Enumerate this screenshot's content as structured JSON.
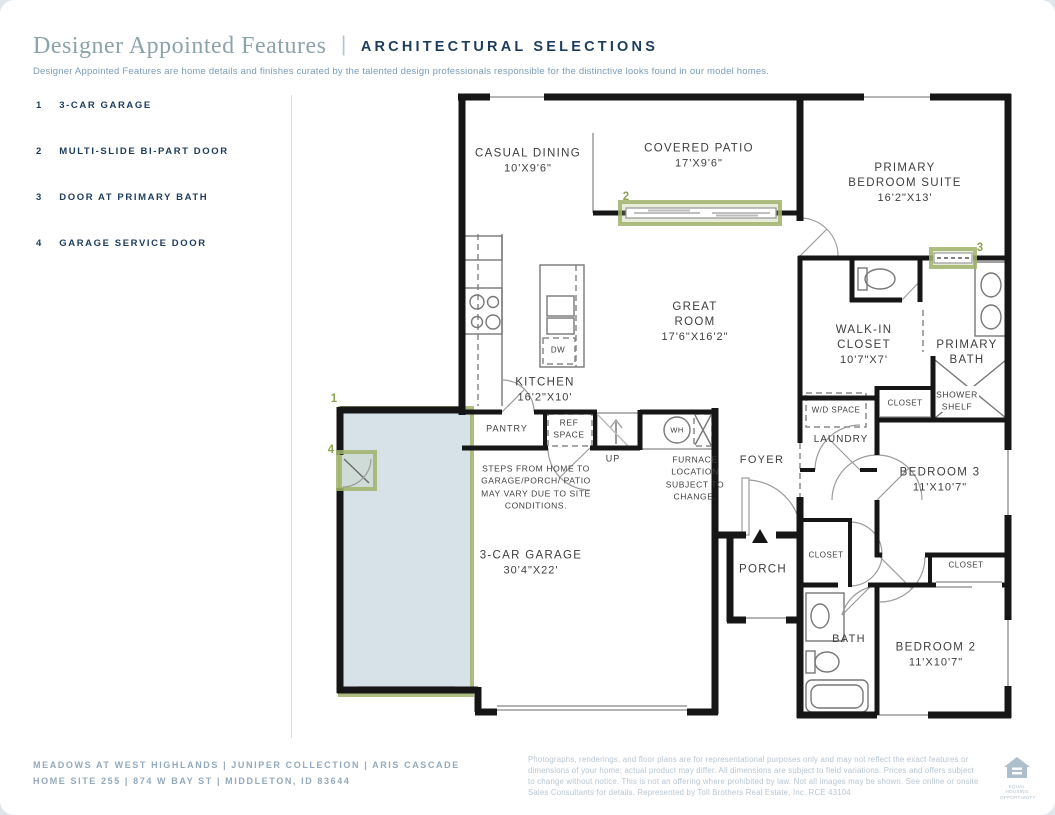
{
  "header": {
    "title": "Designer Appointed Features",
    "divider": "|",
    "tag": "ARCHITECTURAL SELECTIONS",
    "description": "Designer Appointed Features are home details and finishes curated by the talented design professionals responsible for the distinctive looks found in our model homes."
  },
  "features": [
    {
      "num": "1",
      "label": "3-CAR GARAGE"
    },
    {
      "num": "2",
      "label": "MULTI-SLIDE BI-PART DOOR"
    },
    {
      "num": "3",
      "label": "DOOR AT PRIMARY BATH"
    },
    {
      "num": "4",
      "label": "GARAGE SERVICE DOOR"
    }
  ],
  "plan": {
    "casual_dining": {
      "name": "CASUAL DINING",
      "dims": "10'X9'6\""
    },
    "covered_patio": {
      "name": "COVERED PATIO",
      "dims": "17'X9'6\""
    },
    "primary_suite": {
      "name": "PRIMARY BEDROOM SUITE",
      "dims": "16'2\"X13'"
    },
    "great_room": {
      "name": "GREAT ROOM",
      "dims": "17'6\"X16'2\""
    },
    "walk_in_closet": {
      "name": "WALK-IN CLOSET",
      "dims": "10'7\"X7'"
    },
    "primary_bath": {
      "name": "PRIMARY BATH"
    },
    "kitchen": {
      "name": "KITCHEN",
      "dims": "16'2\"X10'"
    },
    "pantry": {
      "name": "PANTRY"
    },
    "ref_space": {
      "name": "REF SPACE"
    },
    "up": {
      "name": "UP"
    },
    "wh": {
      "name": "WH"
    },
    "dw": {
      "name": "DW"
    },
    "wd_space": {
      "name": "W/D SPACE"
    },
    "laundry": {
      "name": "LAUNDRY"
    },
    "linen_closet": {
      "name": "CLOSET"
    },
    "shower_shelf": {
      "name": "SHOWER SHELF"
    },
    "foyer": {
      "name": "FOYER"
    },
    "bedroom3": {
      "name": "BEDROOM 3",
      "dims": "11'X10'7\""
    },
    "hall_closet": {
      "name": "CLOSET"
    },
    "bedroom2_closet": {
      "name": "CLOSET"
    },
    "garage": {
      "name": "3-CAR GARAGE",
      "dims": "30'4\"X22'"
    },
    "porch": {
      "name": "PORCH"
    },
    "bath": {
      "name": "BATH"
    },
    "bedroom2": {
      "name": "BEDROOM 2",
      "dims": "11'X10'7\""
    },
    "notes": {
      "steps": "STEPS FROM HOME TO GARAGE/PORCH/ PATIO MAY VARY DUE TO SITE CONDITIONS.",
      "furnace": "FURNACE LOCATION SUBJECT TO CHANGE."
    }
  },
  "footer": {
    "left_line1": "MEADOWS AT WEST HIGHLANDS  |  JUNIPER COLLECTION  |  ARIS CASCADE",
    "left_line2": "HOME SITE 255  |  874 W BAY ST  |  MIDDLETON, ID 83644",
    "disclaimer": "Photographs, renderings, and floor plans are for representational purposes only and may not reflect the exact features or dimensions of your home; actual product may differ. All dimensions are subject to field variations. Prices and offers subject to change without notice. This is not an offering where prohibited by law. Not all images may be shown. See online or onsite Sales Consultants for details. Represented by Toll Brothers Real Estate, Inc. RCE 43104",
    "equal_housing_caption": "EQUAL HOUSING OPPORTUNITY"
  },
  "colors": {
    "navy": "#1d3c5c",
    "title_gray": "#8da3ab",
    "callout_olive": "#8ca254",
    "highlight_green_border": "#a0b36a",
    "highlight_blue_fill": "#adc4d1",
    "wall_black": "#161616",
    "footer_blue": "#93a9bc"
  }
}
